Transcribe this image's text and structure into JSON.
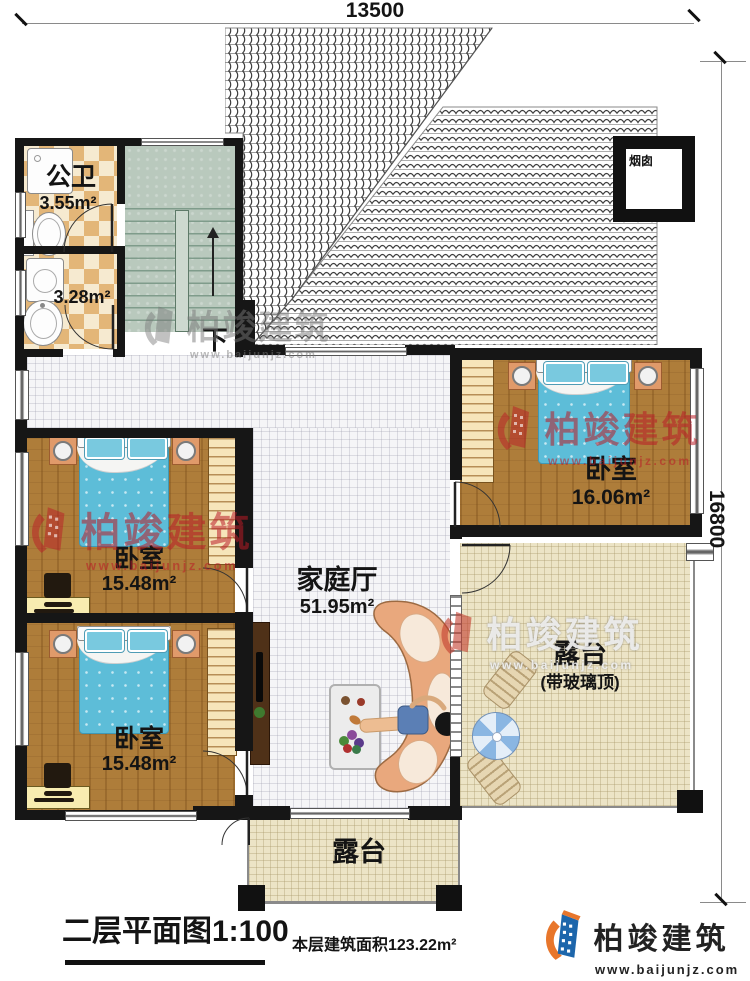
{
  "plan": {
    "dims": {
      "top": "13500",
      "right": "16800"
    },
    "roof": {
      "chimney": "烟囱"
    },
    "stairs": {
      "down": "下"
    },
    "rooms": {
      "bath": {
        "name": "公卫",
        "area": "3.55m²"
      },
      "laundry": {
        "area": "3.28m²"
      },
      "bedroom_mid": {
        "name": "卧室",
        "area": "15.48m²"
      },
      "bedroom_bottom": {
        "name": "卧室",
        "area": "15.48m²"
      },
      "bedroom_right": {
        "name": "卧室",
        "area": "16.06m²"
      },
      "family": {
        "name": "家庭厅",
        "area": "51.95m²"
      },
      "terrace_right": {
        "name": "露台",
        "sub": "(带玻璃顶)"
      },
      "terrace_bottom": {
        "name": "露台"
      }
    },
    "titleblock": {
      "title": "二层平面图1:100",
      "area_note": "本层建筑面积123.22m²"
    },
    "brand": {
      "name": "柏竣建筑",
      "url": "www.baijunjz.com"
    },
    "colors": {
      "wall": "#161616",
      "wood_floor": "#ae7d3a",
      "bed_blue": "#5dbdd8",
      "terrace_floor": "#ece4c6",
      "checker_tile": "#e3b678",
      "stair_floor": "#b9c9bd",
      "sofa": "#e9a87d",
      "watermark_red": "#ba1c26",
      "logo_blue": "#1d66ab",
      "logo_orange": "#e8762b"
    }
  }
}
